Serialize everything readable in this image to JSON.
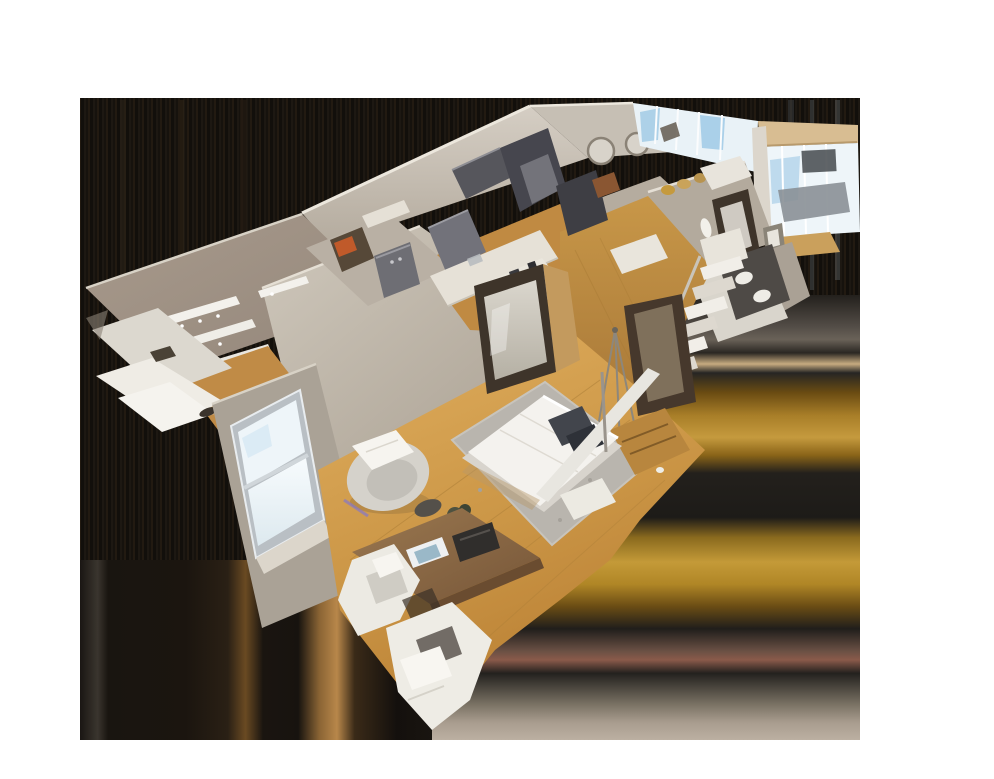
{
  "scene": {
    "type": "3d-dollhouse-cutaway-view",
    "description": "Overhead cutaway (dollhouse) 3D scan of a long apartment, floating over a white canvas; the model's bounding box is filled with dark smeared edge-extension artifacts",
    "regions": [
      "entry-closet",
      "laundry-nook",
      "kitchen",
      "living-area",
      "bathroom",
      "staircase",
      "hallway",
      "bedroom",
      "desk-area"
    ],
    "view": {
      "canvas_width": 994,
      "canvas_height": 779,
      "model_area": {
        "x": 80,
        "y": 98,
        "width": 780,
        "height": 642
      }
    }
  },
  "colors": {
    "canvas_bg": "#ffffff",
    "artifact_base": "#16120e",
    "wall_light": "#d2cbc0",
    "wall_mid": "#b7aea2",
    "wall_dark": "#a29889",
    "closet_wall": "#a3958a",
    "wood_floor": "#c9913f",
    "wood_floor_light": "#e3b469",
    "rug": "#b9b5ae",
    "bed": "#f4f2ee",
    "pillow": "#42454c",
    "chair_white": "#eceae3",
    "desk_wood": "#8a6848",
    "steel": "#6e6e74",
    "steel_dark": "#46464e",
    "window_glass": "#eef5f9",
    "sky": "#9ec8e4",
    "beam_tan": "#d8bd92",
    "door_frame": "#3e342a",
    "mirror_glass": "#cfcac0",
    "accent_orange": "#c05a2a",
    "accent_gold": "#c59a3e",
    "accent_purple": "#8678c8",
    "dresser_wood": "#b8863e"
  }
}
